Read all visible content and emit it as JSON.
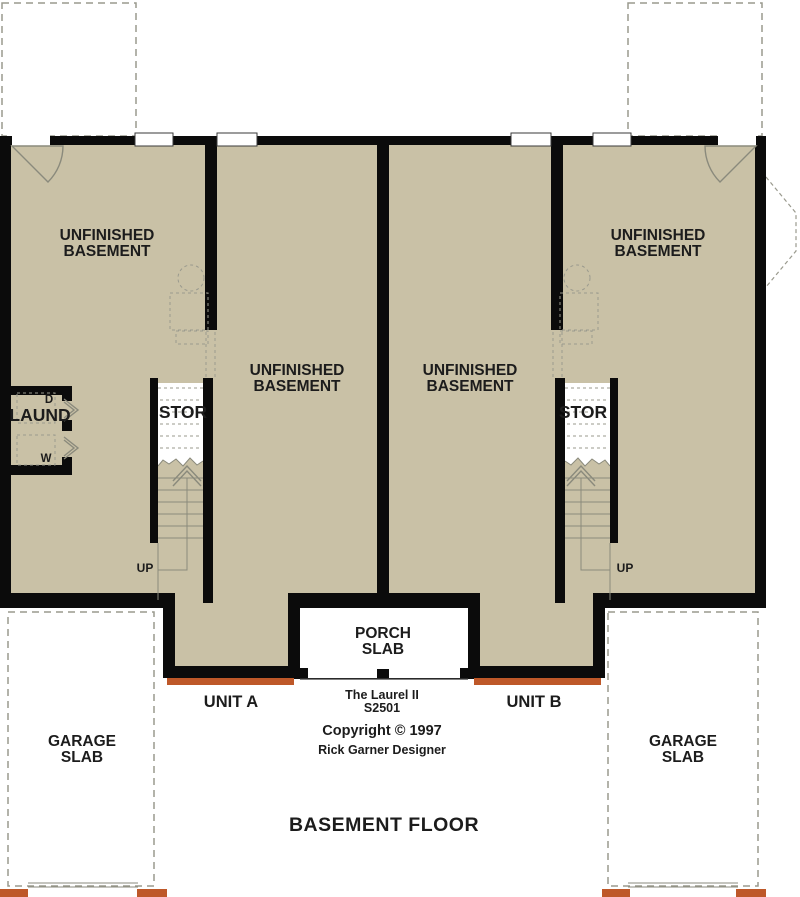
{
  "colors": {
    "floor_tan": "#c9c1a6",
    "wall_black": "#0b0b0b",
    "sill_orange": "#be5829",
    "line_gray": "#8a8a7c",
    "dash_gray": "#9a9a8e"
  },
  "rooms": {
    "unfinished_line1": "UNFINISHED",
    "unfinished_line2": "BASEMENT",
    "laundry": "LAUND",
    "dryer_abbr": "D",
    "washer_abbr": "W",
    "storage": "STOR",
    "up": "UP",
    "porch_line1": "PORCH",
    "porch_line2": "SLAB",
    "garage_line1": "GARAGE",
    "garage_line2": "SLAB"
  },
  "titleblock": {
    "unit_a": "UNIT A",
    "unit_b": "UNIT B",
    "plan_name": "The Laurel II",
    "plan_number": "S2501",
    "copyright_line": "Copyright © 1997",
    "designer": "Rick Garner Designer",
    "sheet_title": "BASEMENT FLOOR"
  }
}
